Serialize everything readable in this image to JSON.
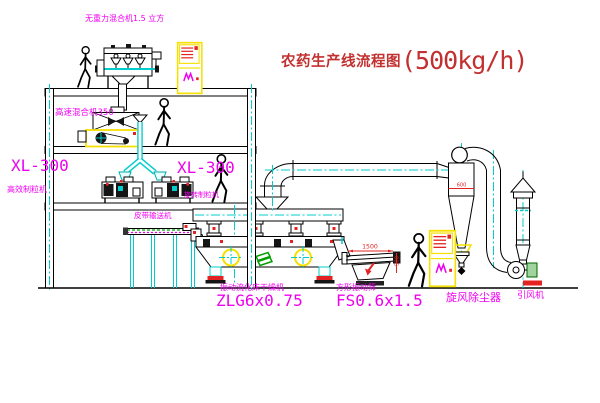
{
  "title": {
    "text": "农药生产线流程图",
    "capacity": "(500kg/h)"
  },
  "labels": {
    "gravity_free_mixer": "无重力混合机1.5 立方",
    "high_speed_mixer": "高速混合机350",
    "granulator_left": {
      "model": "XL-300",
      "name": "高效制粒机"
    },
    "granulator_right": {
      "model": "XL-300",
      "name": "旋转制粒机"
    },
    "belt_conveyor": "皮带输送机",
    "dryer": {
      "name": "振动流化床干燥机",
      "model": "ZLG6x0.75"
    },
    "screen": {
      "name": "方形振动筛",
      "model": "FS0.6x1.5"
    },
    "cyclone": "旋风除尘器",
    "fan": "引风机"
  },
  "dimensions": {
    "screen_length": "1500",
    "screen_height": "500",
    "cyclone_width": "600"
  },
  "colors": {
    "label_magenta": "#f000f0",
    "title_red": "#c23030",
    "detail_red": "#e42222",
    "pipe_cyan": "#00cccc",
    "cabinet_yellow": "#f5e000",
    "machine_green": "#00a000"
  }
}
